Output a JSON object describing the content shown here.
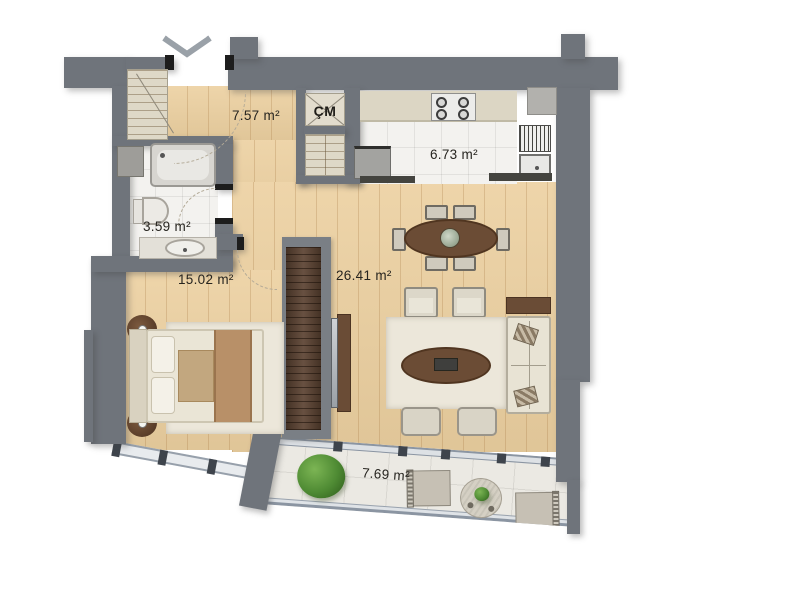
{
  "rooms": {
    "hall": {
      "area": "7.57 m²"
    },
    "kitchen": {
      "area": "6.73 m²"
    },
    "bathroom": {
      "area": "3.59 m²"
    },
    "bedroom": {
      "area": "15.02 m²"
    },
    "living_room": {
      "area": "26.41 m²"
    },
    "balcony": {
      "area": "7.69 m²"
    },
    "cm_closet": {
      "label": "ÇM"
    }
  },
  "icons": {
    "entrance_arrow": "chevron-down"
  },
  "colors": {
    "wall": "#6f747b",
    "floor_wood": "#ecd0a0",
    "interior_tile": "#f3f2ef",
    "balcony_tile": "#ebe9e3",
    "wardrobe_wood": "#5b4231",
    "furniture_wood": "#6b4c35",
    "window_frame": "#8b95a2",
    "label_text": "#26241f"
  }
}
